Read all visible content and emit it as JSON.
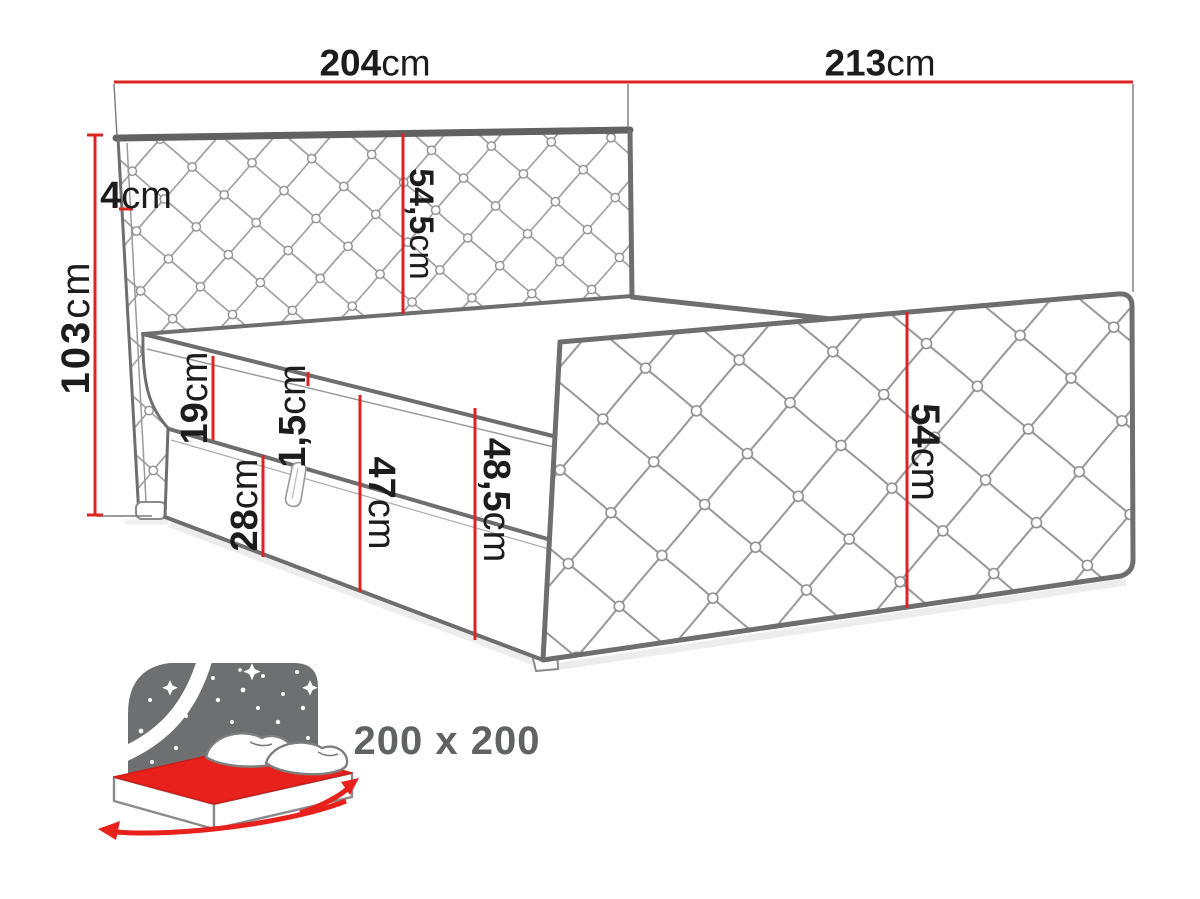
{
  "diagram": {
    "title": "upholstered-bed-dimension-diagram",
    "dimensions": [
      {
        "id": "top-width-left",
        "value": "204",
        "unit": "cm"
      },
      {
        "id": "top-width-right",
        "value": "213",
        "unit": "cm"
      },
      {
        "id": "total-height",
        "value": "103",
        "unit": "cm"
      },
      {
        "id": "headboard-thickness",
        "value": "4",
        "unit": "cm"
      },
      {
        "id": "headboard-height",
        "value": "54,5",
        "unit": "cm"
      },
      {
        "id": "mattress-height",
        "value": "19",
        "unit": "cm"
      },
      {
        "id": "topper-seam",
        "value": "1,5",
        "unit": "cm"
      },
      {
        "id": "box-height",
        "value": "28",
        "unit": "cm"
      },
      {
        "id": "side-height-mid",
        "value": "47",
        "unit": "cm"
      },
      {
        "id": "side-height-foot",
        "value": "48,5",
        "unit": "cm"
      },
      {
        "id": "footboard-height",
        "value": "54",
        "unit": "cm"
      }
    ],
    "size_label": {
      "value": "200 x 200"
    },
    "icon": "double-bed-size-icon",
    "colors": {
      "dimension_red": "#dd2420",
      "outline_gray": "#6e6e6e",
      "pattern_gray": "#9b9b9b",
      "text_black": "#1c1c1c",
      "icon_gray": "#6d6f71",
      "size_text_gray": "#606264"
    }
  }
}
